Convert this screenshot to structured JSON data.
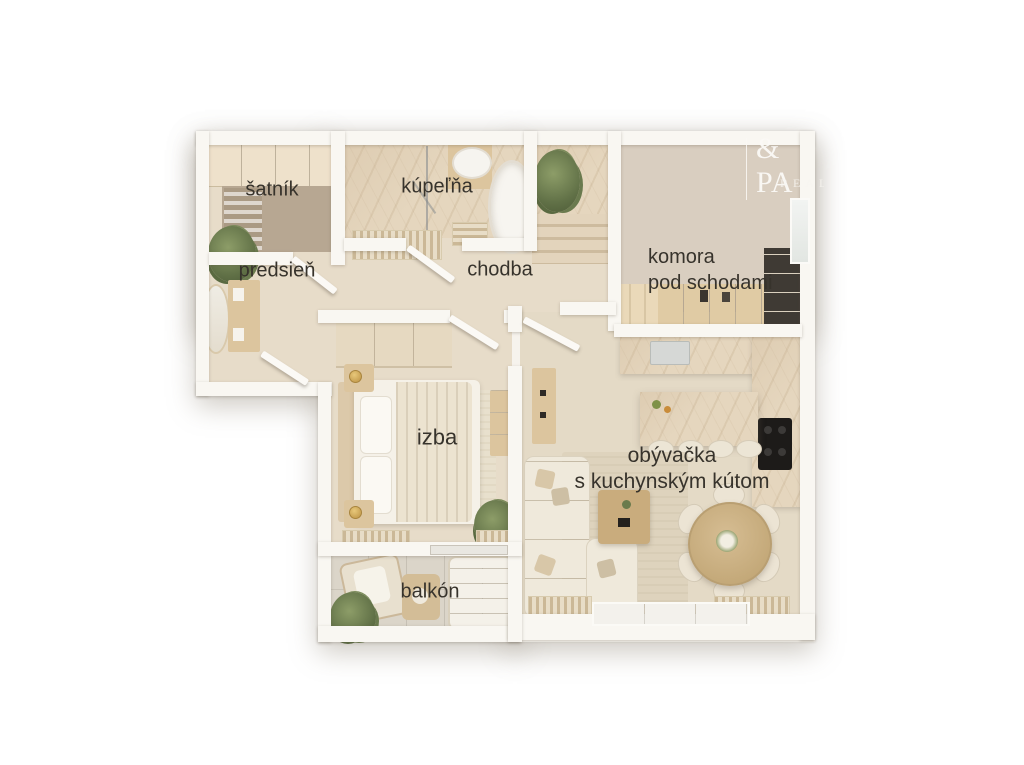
{
  "plan": {
    "language": "sk",
    "rooms": {
      "satnik": {
        "label": "šatník"
      },
      "kupelna": {
        "label": "kúpeľňa"
      },
      "predsien": {
        "label": "predsieň"
      },
      "chodba": {
        "label": "chodba"
      },
      "komora": {
        "label_line1": "komora",
        "label_line2": "pod schodami"
      },
      "izba": {
        "label": "izba"
      },
      "obyvacka": {
        "label_line1": "obývačka",
        "label_line2": "s kuchynským kútom"
      },
      "balkon": {
        "label": "balkón"
      }
    },
    "furniture": {
      "satnik": [
        "wardrobe-cabinets",
        "clothes-rail"
      ],
      "kupelna": [
        "bathtub",
        "sink-with-round-mirror",
        "shower",
        "bath-mat"
      ],
      "predsien": [
        "mirror",
        "console",
        "plant"
      ],
      "chodba": [
        "entry-mat"
      ],
      "komora": [
        "steps",
        "shelf-cabinets",
        "dark-shelf-unit",
        "window"
      ],
      "izba": [
        "double-bed",
        "nightstand-with-lamp",
        "nightstand-with-lamp",
        "wardrobe",
        "dresser",
        "rug",
        "plant",
        "floor-vents"
      ],
      "obyvacka": [
        "corner-sofa",
        "throw-pillows",
        "coffee-table",
        "rug",
        "round-dining-table",
        "dining-chairs-x6",
        "kitchen-island",
        "bar-stools-x4",
        "kitchen-counter-with-sink",
        "cooktop",
        "side-console",
        "floor-vents",
        "sliding-glass-door"
      ],
      "balkon": [
        "armchair",
        "lounger",
        "side-table",
        "plant"
      ]
    }
  },
  "watermark": {
    "line1": "& PA",
    "line2": "REALI"
  },
  "colors": {
    "background": "#ffffff",
    "wall": "#f9f7f2",
    "floor_beige": "#e7dcc9",
    "closet_floor_taupe": "#b7a792",
    "marble": "#e5d6be",
    "balcony_tile": "#dbd5c9",
    "wood": "#dcc59e",
    "upholstery_cream": "#efe9db",
    "cooktop_black": "#1d1b19",
    "plant_green": "#617147",
    "lamp_gold": "#c9a254",
    "label_text": "#37332c",
    "watermark_text": "#fbf9f5"
  }
}
